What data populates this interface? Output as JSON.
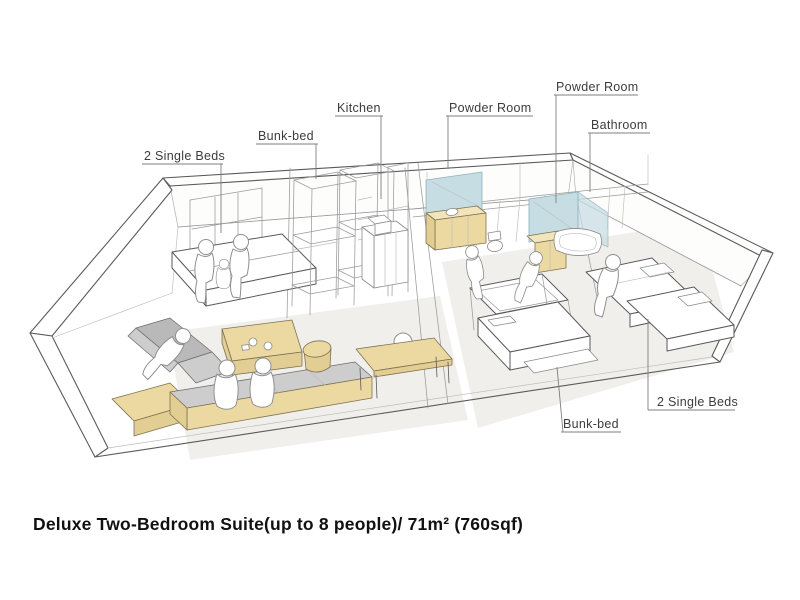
{
  "caption": "Deluxe Two-Bedroom Suite(up to 8 people)/ 71m² (760sqf)",
  "labels": {
    "single_beds_left": "2 Single Beds",
    "bunk_bed_top": "Bunk-bed",
    "kitchen": "Kitchen",
    "powder_room_center": "Powder Room",
    "powder_room_right": "Powder Room",
    "bathroom": "Bathroom",
    "bunk_bed_bottom": "Bunk-bed",
    "single_beds_right": "2 Single Beds"
  },
  "colors": {
    "wood": "#ecd9a2",
    "wood_dark": "#e2cd92",
    "wood_light": "#f3e5bb",
    "glass": "#c7dde4",
    "sofa_gray": "#b9b9b9",
    "cushion_gray": "#cdcdcd",
    "floor_shade": "#f0efeb",
    "outline": "#5a5a5a",
    "label_text": "#3c3c3c",
    "caption_text": "#111111"
  }
}
